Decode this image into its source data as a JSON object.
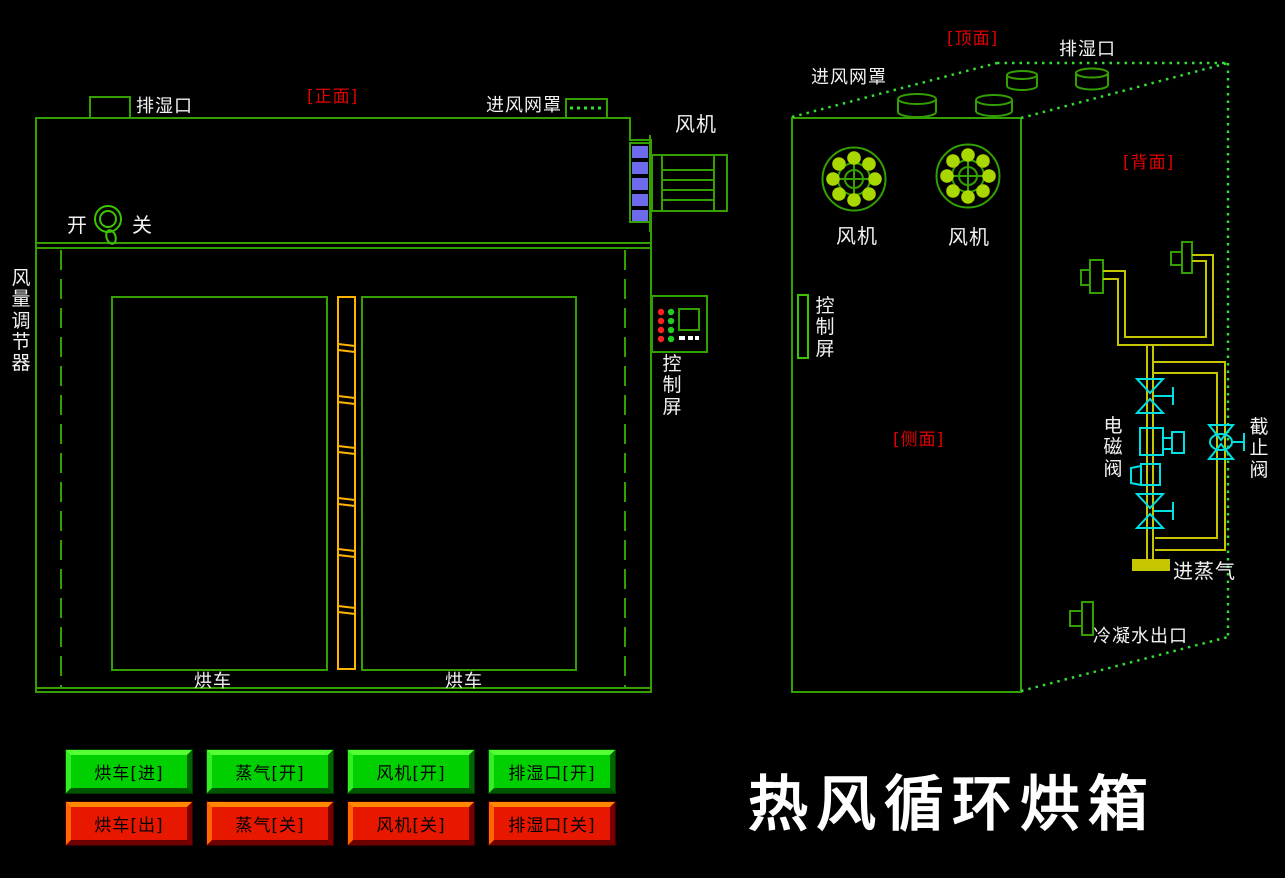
{
  "title": "热风循环烘箱",
  "colors": {
    "background": "#000000",
    "line_green": "#33a000",
    "dot_green": "#33dd33",
    "fan_blade_green": "#a8d800",
    "pipe_yellow": "#c6c600",
    "hinge_gold": "#ffb400",
    "valve_cyan": "#00e0e0",
    "fan_blue": "#6b6beb",
    "label_red": "#e00000",
    "button_green": "#00cf00",
    "button_red": "#e81800",
    "text_white": "#f2f2f2"
  },
  "front_view": {
    "view_label": "[正面]",
    "exhaust_port": "排湿口",
    "inlet_mesh": "进风网罩",
    "fan": "风机",
    "switch_on": "开",
    "switch_off": "关",
    "air_regulator": "风量调节器",
    "control_screen": "控制屏",
    "cart_left": "烘车",
    "cart_right": "烘车"
  },
  "side_view": {
    "top_label": "[顶面]",
    "back_label": "[背面]",
    "side_label": "[侧面]",
    "exhaust_port": "排湿口",
    "inlet_mesh": "进风网罩",
    "fan_left": "风机",
    "fan_right": "风机",
    "control_screen": "控制屏",
    "solenoid_valve": "电磁阀",
    "stop_valve": "截止阀",
    "steam_inlet": "进蒸气",
    "condensate_outlet": "冷凝水出口"
  },
  "buttons": [
    {
      "label": "烘车[进]",
      "state": "green"
    },
    {
      "label": "蒸气[开]",
      "state": "green"
    },
    {
      "label": "风机[开]",
      "state": "green"
    },
    {
      "label": "排湿口[开]",
      "state": "green"
    },
    {
      "label": "烘车[出]",
      "state": "red"
    },
    {
      "label": "蒸气[关]",
      "state": "red"
    },
    {
      "label": "风机[关]",
      "state": "red"
    },
    {
      "label": "排湿口[关]",
      "state": "red"
    }
  ]
}
